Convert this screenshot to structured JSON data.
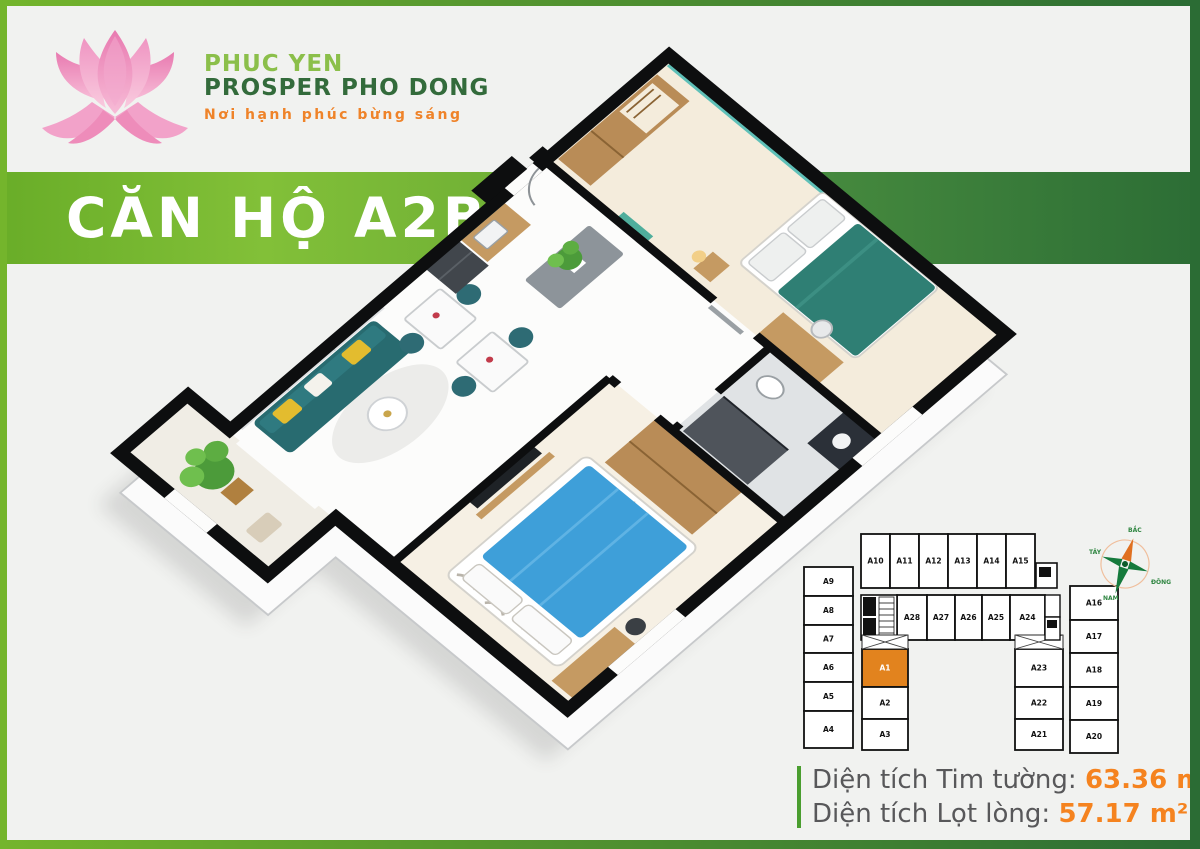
{
  "brand": {
    "line1": "PHUC YEN",
    "line2": "PROSPER PHO DONG",
    "tagline": "Nơi hạnh phúc bừng sáng"
  },
  "banner": {
    "title": "CĂN HỘ A2B"
  },
  "areas": {
    "gross_label": "Diện tích Tim tường:",
    "gross_value": "63.36 m²",
    "net_label": "Diện tích Lọt lòng:",
    "net_value": "57.17 m²"
  },
  "key_plan": {
    "highlighted_unit": "A1",
    "left_column": [
      "A9",
      "A8",
      "A7",
      "A6",
      "A5",
      "A4"
    ],
    "top_row": [
      "A10",
      "A11",
      "A12",
      "A13",
      "A14",
      "A15"
    ],
    "middle_row": [
      "A28",
      "A27",
      "A26",
      "A25",
      "A24"
    ],
    "center_column": [
      "A1",
      "A2",
      "A3"
    ],
    "right_inner_column": [
      "A23",
      "A22",
      "A21"
    ],
    "right_outer_column": [
      "A16",
      "A17",
      "A18",
      "A19",
      "A20"
    ]
  },
  "compass": {
    "north": "BẮC",
    "south": "NAM",
    "east": "ĐÔNG",
    "west": "TÂY"
  },
  "colors": {
    "accent_orange": "#f5831f",
    "brand_green_light": "#8bc53f",
    "brand_green_dark": "#2e6e36",
    "highlight_unit_fill": "#e2831e",
    "label_gray": "#58585a"
  }
}
